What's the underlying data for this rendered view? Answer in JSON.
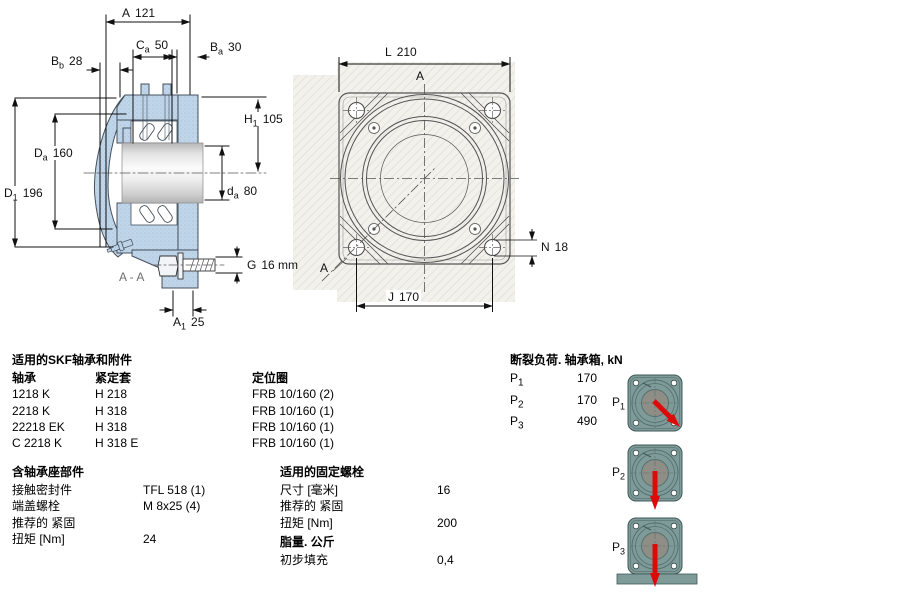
{
  "colors": {
    "housing_blue": "#c2d6ea",
    "drawing_line": "#44505c",
    "flange_teal": "#7e9b9a",
    "load_arrow_red": "#dd0a0a",
    "hatch_background": "#f2f1ec"
  },
  "left_drawing": {
    "dim_a": {
      "sym": "A",
      "sub": "",
      "val": "121"
    },
    "dim_ca": {
      "sym": "C",
      "sub": "a",
      "val": "50"
    },
    "dim_ba": {
      "sym": "B",
      "sub": "a",
      "val": "30"
    },
    "dim_bb": {
      "sym": "B",
      "sub": "b",
      "val": "28"
    },
    "dim_h1": {
      "sym": "H",
      "sub": "1",
      "val": "105"
    },
    "dim_da_housing": {
      "sym": "D",
      "sub": "a",
      "val": "160"
    },
    "dim_d1": {
      "sym": "D",
      "sub": "1",
      "val": "196"
    },
    "dim_da_shaft": {
      "sym": "d",
      "sub": "a",
      "val": "80"
    },
    "dim_g": {
      "sym": "G",
      "sub": "",
      "val": "16 mm"
    },
    "dim_a1": {
      "sym": "A",
      "sub": "1",
      "val": "25"
    },
    "section_label": "A - A"
  },
  "right_drawing": {
    "dim_l": {
      "sym": "L",
      "sub": "",
      "val": "210"
    },
    "dim_n": {
      "sym": "N",
      "sub": "",
      "val": "18"
    },
    "dim_j": {
      "sym": "J",
      "sub": "",
      "val": "170"
    },
    "section_mark_top": "A",
    "section_mark_corner": "A"
  },
  "bearing_table": {
    "title": "适用的SKF轴承和附件",
    "col_bearing": "轴承",
    "col_sleeve": "紧定套",
    "col_ring": "定位圈",
    "rows": [
      {
        "bearing": "1218 K",
        "sleeve": "H 218",
        "ring": "FRB 10/160  (2)"
      },
      {
        "bearing": "2218 K",
        "sleeve": "H 318",
        "ring": "FRB 10/160  (1)"
      },
      {
        "bearing": "22218 EK",
        "sleeve": "H 318",
        "ring": "FRB 10/160  (1)"
      },
      {
        "bearing": "C 2218 K",
        "sleeve": "H 318 E",
        "ring": "FRB 10/160  (1)"
      }
    ]
  },
  "housing_parts": {
    "title": "含轴承座部件",
    "rows": [
      {
        "label": "接触密封件",
        "value": "TFL 518  (1)"
      },
      {
        "label": "端盖螺栓",
        "value": "M 8x25  (4)"
      },
      {
        "label": "推荐的 紧固",
        "value": ""
      },
      {
        "label": "扭矩 [Nm]",
        "value": "24"
      }
    ]
  },
  "fixing_bolts": {
    "title": "适用的固定螺栓",
    "rows": [
      {
        "label": "尺寸 [毫米]",
        "value": "16"
      },
      {
        "label": "推荐的 紧固",
        "value": ""
      },
      {
        "label": "扭矩 [Nm]",
        "value": "200"
      }
    ]
  },
  "grease": {
    "title": "脂量. 公斤",
    "rows": [
      {
        "label": "初步填充",
        "value": "0,4"
      }
    ]
  },
  "breaking_loads": {
    "title": "断裂负荷. 轴承箱, kN",
    "rows": [
      {
        "sym": "P",
        "sub": "1",
        "val": "170"
      },
      {
        "sym": "P",
        "sub": "2",
        "val": "170"
      },
      {
        "sym": "P",
        "sub": "3",
        "val": "490"
      }
    ]
  }
}
